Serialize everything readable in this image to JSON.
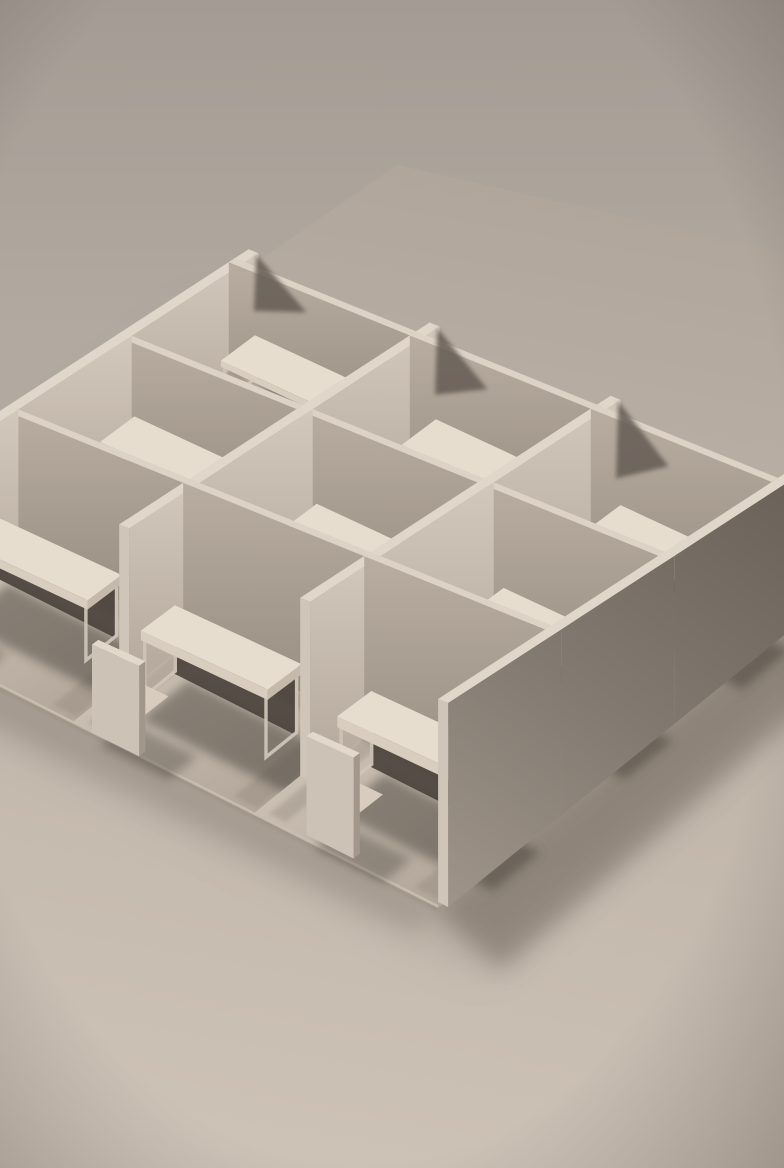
{
  "scene": {
    "alt": "Monochrome beige architectural scale model of nine office cubicles in a 3x3 grid, each with a desk and chair, viewed from above at an angle on a plain tabletop",
    "canvas": {
      "width": 784,
      "height": 1168
    },
    "background": {
      "sky_top": "#a49c94",
      "sky_bottom": "#b2a9a0",
      "plane_corner": [
        397,
        165
      ],
      "plane_right": [
        784,
        253
      ],
      "plane_left": [
        0,
        440
      ],
      "plane_far": "#b0a69c",
      "plane_mid": "#bfb4a8",
      "plane_near": "#cdc2b6",
      "vignette_color": "30,24,20",
      "vignette_opacity": 0.26
    },
    "projection": {
      "origin": [
        235,
        353
      ],
      "u": [
        181,
        91.3
      ],
      "v": [
        -113.3,
        91.7
      ],
      "wall_base_px": 95,
      "wall_per_depth_px": 18
    },
    "grid": {
      "cols": 3,
      "rows": 3,
      "wall_thickness": 0.055,
      "fin_overhang": 0.12,
      "desk_top_z": 0.4,
      "desk_slab_dz": 0.06,
      "chair_seat_z": 0.2,
      "chair_back_z": 0.52
    },
    "colors": {
      "wall_top_u": "#dcd2c5",
      "wall_top_v": "#e0d6c9",
      "wall_end": "#c8bdb0",
      "sw_top": "#b8ada0",
      "sw_bottom": "#948a7e",
      "se_top": "#d2c8bb",
      "se_bottom": "#b2a79a",
      "outer_0": "#6b625a",
      "outer_1": "#837a71",
      "outer_2": "#9d9389",
      "floor_light": "#d3c9bc",
      "floor_dark": "#a99d90",
      "desk_top": "#e7ddce",
      "desk_front": "#d8cdbf",
      "desk_side": "#c4b9ab",
      "desk_frame": "#cdc3b6",
      "desk_under": "#453e38",
      "chair_back": "#ccc2b5",
      "chair_side": "#a2978a",
      "chair_top": "#e3d9cb",
      "chair_seat": "#d7ccbe",
      "chair_seat_front": "#b2a79a",
      "chair_post": "#8d8276",
      "shadow": "#3e3831",
      "ao": "#857a6e",
      "fin_shadow": "#655c54",
      "slab_edge": "#cfc4b6",
      "slab_under": "#857a6e",
      "cast": "#6b6157"
    },
    "walls": {
      "u_lines": [
        {
          "j": 0,
          "spans": [
            [
              0,
              1
            ],
            [
              1,
              2
            ],
            [
              2,
              3
            ]
          ]
        },
        {
          "j": 1,
          "spans": [
            [
              0,
              1
            ],
            [
              1,
              2
            ],
            [
              2,
              3
            ]
          ]
        },
        {
          "j": 2,
          "spans": [
            [
              0,
              1
            ],
            [
              1,
              2
            ],
            [
              2,
              3
            ]
          ]
        }
      ],
      "v_lines": [
        {
          "i": 0,
          "spans": [
            [
              -0.12,
              1
            ],
            [
              1,
              2
            ],
            [
              2,
              3
            ]
          ]
        },
        {
          "i": 1,
          "spans": [
            [
              -0.12,
              1
            ],
            [
              1,
              2
            ],
            [
              2,
              2.62
            ]
          ]
        },
        {
          "i": 2,
          "spans": [
            [
              -0.12,
              1
            ],
            [
              1,
              2
            ],
            [
              2,
              2.62
            ]
          ]
        },
        {
          "i": 3,
          "spans": [
            [
              -0.12,
              1
            ],
            [
              1,
              2
            ],
            [
              2,
              3
            ]
          ]
        }
      ]
    },
    "fin_shadow_cols": [
      0,
      1,
      2,
      3
    ],
    "cubicles": [
      {
        "i": 0,
        "j": 0,
        "desk": {
          "x": [
            0.16,
            0.86
          ],
          "y": [
            0.08,
            0.38
          ]
        },
        "chair": {
          "x": 0.3,
          "y": 0.6
        }
      },
      {
        "i": 1,
        "j": 0,
        "desk": {
          "x": [
            1.16,
            1.86
          ],
          "y": [
            0.08,
            0.38
          ]
        },
        "chair": {
          "x": 1.36,
          "y": 0.64
        }
      },
      {
        "i": 2,
        "j": 0,
        "desk": {
          "x": [
            2.18,
            2.88
          ],
          "y": [
            0.08,
            0.38
          ]
        },
        "chair": {
          "x": 2.36,
          "y": 0.6
        }
      },
      {
        "i": 0,
        "j": 1,
        "desk": {
          "x": [
            0.12,
            0.82
          ],
          "y": [
            1.08,
            1.38
          ]
        },
        "chair": {
          "x": 0.26,
          "y": 1.62
        }
      },
      {
        "i": 1,
        "j": 1,
        "desk": {
          "x": [
            1.14,
            1.84
          ],
          "y": [
            1.1,
            1.4
          ]
        },
        "chair": {
          "x": 1.32,
          "y": 1.66
        }
      },
      {
        "i": 2,
        "j": 1,
        "desk": {
          "x": [
            2.16,
            2.86
          ],
          "y": [
            1.08,
            1.38
          ]
        },
        "chair": {
          "x": 2.34,
          "y": 1.62
        }
      },
      {
        "i": 0,
        "j": 2,
        "desk": {
          "x": [
            0.1,
            0.8
          ],
          "y": [
            2.28,
            2.58
          ]
        },
        "chair": {
          "x": 0.16,
          "y": 2.84
        }
      },
      {
        "i": 1,
        "j": 2,
        "desk": {
          "x": [
            1.12,
            1.82
          ],
          "y": [
            2.32,
            2.62
          ]
        },
        "chair": {
          "x": 1.24,
          "y": 2.88
        }
      },
      {
        "i": 2,
        "j": 2,
        "desk": {
          "x": [
            2.18,
            2.88
          ],
          "y": [
            2.28,
            2.58
          ]
        },
        "chair": {
          "x": 2.4,
          "y": 2.84
        }
      }
    ]
  }
}
